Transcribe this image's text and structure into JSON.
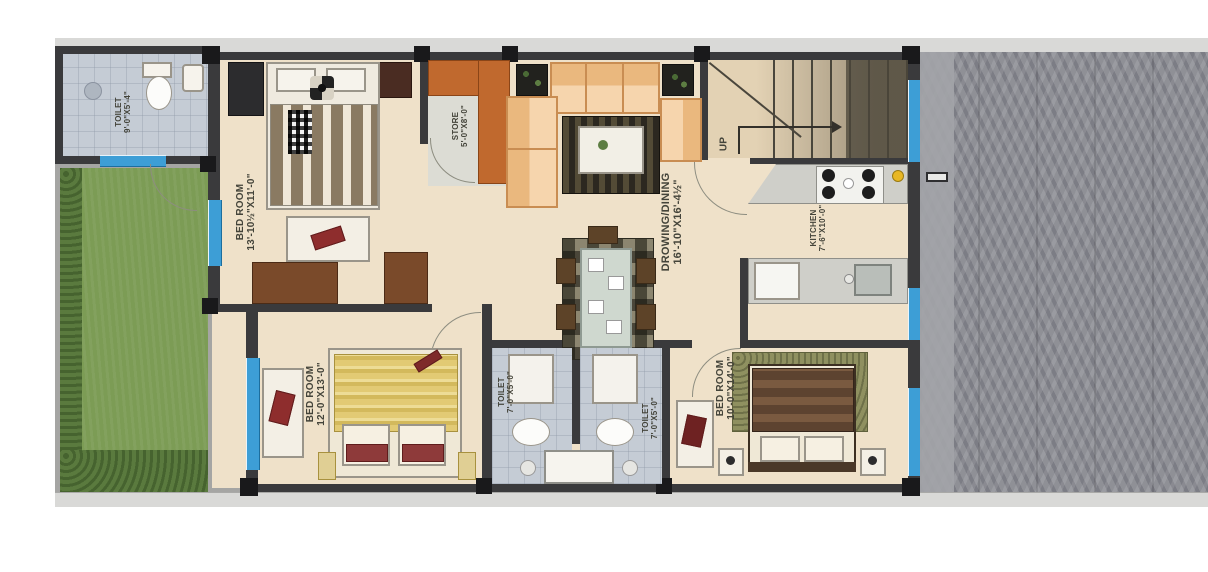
{
  "plan": {
    "title": "residential-floor-plan",
    "rooms": {
      "toilet_top": {
        "name": "TOILET",
        "dim": "9'-0\"X5'-4\""
      },
      "bedroom_top": {
        "name": "BED ROOM",
        "dim": "13'-10½\"X11'-0\""
      },
      "store": {
        "name": "STORE",
        "dim": "5'-0\"X8'-0\""
      },
      "drawing_dining": {
        "name": "DROWING/DINING",
        "dim": "16'-10\"X16'-4½\""
      },
      "kitchen": {
        "name": "KITCHEN",
        "dim": "7'-6\"X10'-0\""
      },
      "bedroom_left": {
        "name": "BED ROOM",
        "dim": "12'-0\"X13'-0\""
      },
      "toilet_left": {
        "name": "TOILET",
        "dim": "7'-0\"X5'-0\""
      },
      "toilet_right": {
        "name": "TOILET",
        "dim": "7'-0\"X5'-0\""
      },
      "bedroom_right": {
        "name": "BED ROOM",
        "dim": "10'-0\"X14'-0\""
      }
    },
    "stairs": {
      "label": "UP"
    },
    "colors": {
      "wall": "#3a3a3c",
      "window_blue": "#3d9ed6",
      "floor_beige": "#efe1c9",
      "tile_gray": "#c5ccd5",
      "lawn_green": "#7c9c55",
      "hedge_green": "#50703a",
      "path_gray": "#a5a5a3",
      "paving_gray": "#8f9096",
      "sofa_peach": "#f2c795",
      "wardrobe_orange": "#c0692e",
      "bed_yellow": "#e2ca74",
      "bed_brown": "#5d4330",
      "cushion_red": "#8e2d2d"
    }
  }
}
